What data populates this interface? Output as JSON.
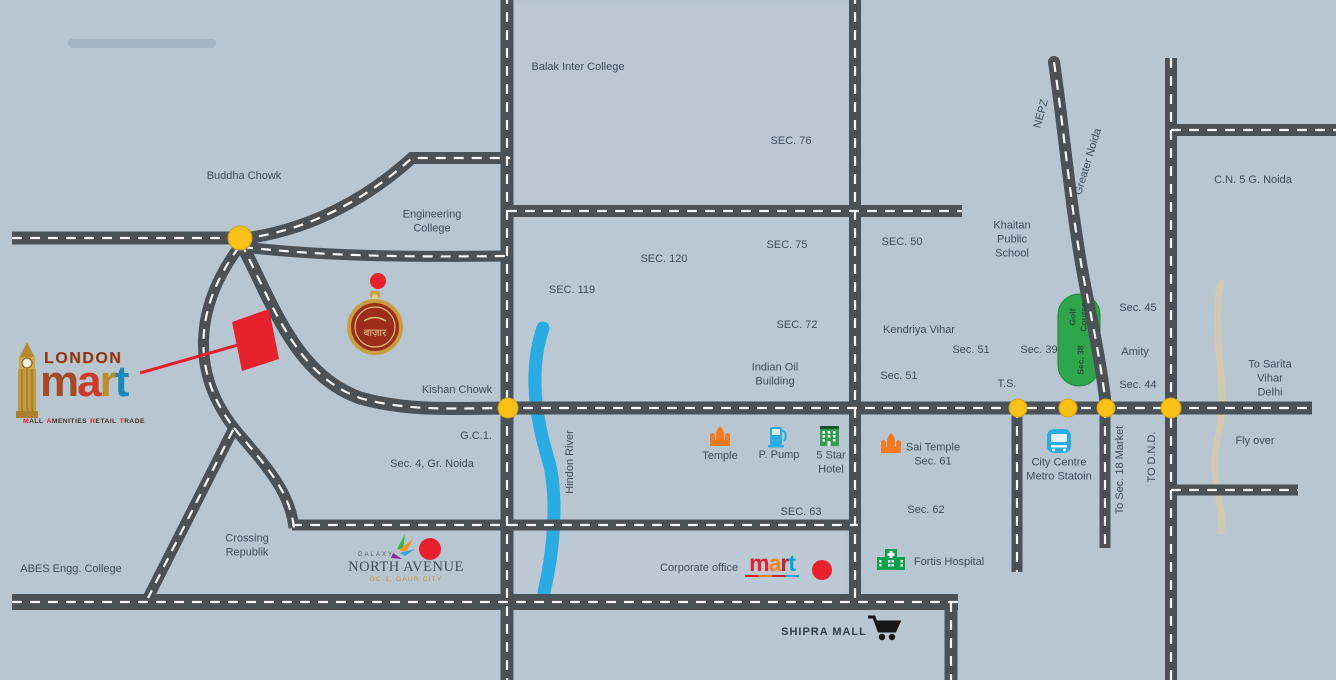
{
  "map": {
    "background": "#b8c6d2",
    "road_color": "#4a5157",
    "river_color": "#2aabe2",
    "golf_color": "#2fa64c",
    "junction_color": "#f8c117",
    "marker_color": "#e8212e"
  },
  "logo": {
    "line1": "LONDON",
    "mart_letters": [
      "m",
      "a",
      "r",
      "t"
    ],
    "tagline_words": [
      "MALL",
      "AMENITIES",
      "RETAIL",
      "TRADE"
    ]
  },
  "emblem": {
    "text": "बाज़ार"
  },
  "brands": {
    "corporate_office": "Corporate office",
    "mart_letters": [
      "m",
      "a",
      "r",
      "t"
    ],
    "north_avenue_top": "GALAXY",
    "north_avenue": "NORTH AVENUE",
    "north_avenue_sub": "GC-1, GAUR CITY"
  },
  "labels": {
    "balak": "Balak Inter College",
    "sec76": "SEC. 76",
    "buddha_chowk": "Buddha Chowk",
    "engineering_college": "Engineering\nCollege",
    "sec120": "SEC. 120",
    "sec75": "SEC. 75",
    "sec50": "SEC. 50",
    "sec119": "SEC. 119",
    "nepz": "NEPZ",
    "greater_noida": "Greater Noida",
    "cn5": "C.N. 5 G. Noida",
    "khaitan": "Khaitan\nPublic\nSchool",
    "sec72": "SEC. 72",
    "kendriya_vihar": "Kendriya Vihar",
    "sec51a": "Sec. 51",
    "sec39": "Sec. 39",
    "sec45": "Sec. 45",
    "amity": "Amity",
    "sec51b": "Sec. 51",
    "sec44": "Sec. 44",
    "sarita": "To Sarita Vihar\nDelhi",
    "indian_oil": "Indian Oil\nBuilding",
    "kishan_chowk": "Kishan Chowk",
    "ts": "T.S.",
    "gc1": "G.C.1.",
    "sec4": "Sec. 4, Gr. Noida",
    "hindon_river": "Hindon River",
    "temple": "Temple",
    "p_pump": "P. Pump",
    "five_star": "5 Star\nHotel",
    "sai_temple": "Sai Temple\nSec. 61",
    "city_centre": "City Centre\nMetro Statoin",
    "to_sec18": "To Sec. 18 Market",
    "to_dnd": "TO D.N.D.",
    "fly_over": "Fly over",
    "sec63": "SEC. 63",
    "sec62": "Sec. 62",
    "crossing": "Crossing\nRepublik",
    "abes": "ABES Engg. College",
    "golf_course": "Golf\nCourse",
    "golf_sec": "Sec. 38",
    "fortis": "Fortis Hospital",
    "shipra": "SHIPRA MALL"
  }
}
